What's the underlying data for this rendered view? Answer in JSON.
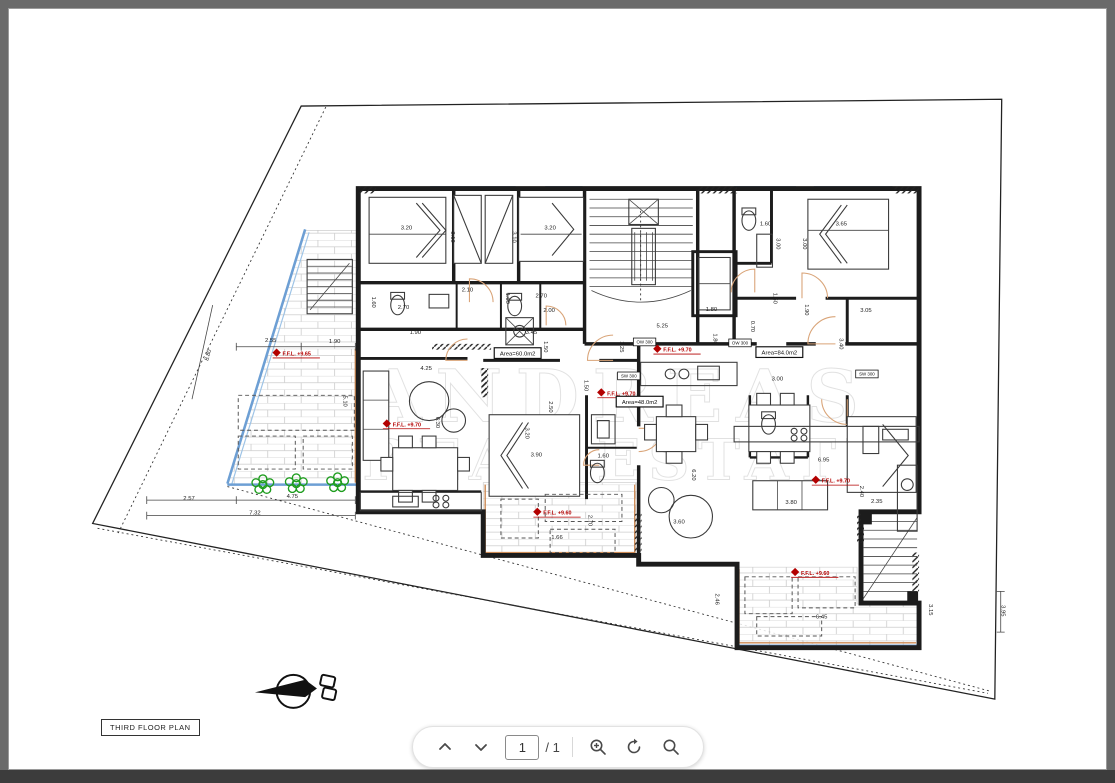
{
  "viewer": {
    "background_color": "#6a6a6a",
    "bottom_bar_color": "#3c3c3c",
    "title_box_label": "THIRD FLOOR PLAN",
    "toolbar": {
      "page_value": "1",
      "page_total": "/ 1",
      "icons": [
        "chevron-up",
        "chevron-down",
        "zoom-in",
        "rotate",
        "search"
      ]
    }
  },
  "watermark": {
    "line1": "ANDREAS",
    "line2": "REAL ESTATE"
  },
  "plan": {
    "colors": {
      "balcony_edge": "#6d9fd4",
      "door_arc": "#d9a478",
      "railing": "#cc8a54",
      "ffl_label": "#b30000",
      "plant": "#1f9d1f"
    },
    "area_labels": [
      {
        "text": "Area=60.0m2",
        "x": 517,
        "y": 357
      },
      {
        "text": "Area=48.0m2",
        "x": 641,
        "y": 407
      },
      {
        "text": "Area=84.0m2",
        "x": 783,
        "y": 356
      }
    ],
    "ffl_labels": [
      {
        "text": "F.F.L. +9.65",
        "x": 278,
        "y": 357
      },
      {
        "text": "F.F.L. +9.70",
        "x": 390,
        "y": 430
      },
      {
        "text": "F.F.L. +9.70",
        "x": 665,
        "y": 353
      },
      {
        "text": "F.F.L. +9.70",
        "x": 608,
        "y": 398
      },
      {
        "text": "F.F.L. +9.70",
        "x": 826,
        "y": 488
      },
      {
        "text": "F.F.L. +9.60",
        "x": 543,
        "y": 521
      },
      {
        "text": "F.F.L. +9.60",
        "x": 805,
        "y": 583
      }
    ],
    "window_tags": [
      {
        "text": "OW 300",
        "x": 646,
        "y": 345
      },
      {
        "text": "OW 300",
        "x": 743,
        "y": 346
      },
      {
        "text": "SW 300",
        "x": 630,
        "y": 380
      },
      {
        "text": "SW 300",
        "x": 872,
        "y": 378
      }
    ],
    "dimensions": [
      {
        "t": "3.20",
        "x": 404,
        "y": 227
      },
      {
        "t": "3.10",
        "x": 449,
        "y": 235,
        "r": 90
      },
      {
        "t": "3.20",
        "x": 550,
        "y": 227
      },
      {
        "t": "3.10",
        "x": 512,
        "y": 235,
        "r": 90
      },
      {
        "t": "2.10",
        "x": 466,
        "y": 291
      },
      {
        "t": "2.70",
        "x": 541,
        "y": 297
      },
      {
        "t": "2.00",
        "x": 549,
        "y": 312
      },
      {
        "t": "2.70",
        "x": 401,
        "y": 309
      },
      {
        "t": "1.60",
        "x": 369,
        "y": 302,
        "r": 90
      },
      {
        "t": "1.60",
        "x": 505,
        "y": 298,
        "r": 90
      },
      {
        "t": "1.90",
        "x": 413,
        "y": 335
      },
      {
        "t": "3.45",
        "x": 531,
        "y": 335
      },
      {
        "t": "1.50",
        "x": 544,
        "y": 348,
        "r": 90
      },
      {
        "t": "5.25",
        "x": 664,
        "y": 328
      },
      {
        "t": "1.25",
        "x": 621,
        "y": 348,
        "r": 90
      },
      {
        "t": "1.80",
        "x": 714,
        "y": 311
      },
      {
        "t": "1.80",
        "x": 716,
        "y": 340,
        "r": 90
      },
      {
        "t": "2.55",
        "x": 266,
        "y": 343
      },
      {
        "t": "1.90",
        "x": 331,
        "y": 344
      },
      {
        "t": "8.80",
        "x": 204,
        "y": 357,
        "r": -75
      },
      {
        "t": "5.10",
        "x": 340,
        "y": 404,
        "r": 90
      },
      {
        "t": "2.57",
        "x": 183,
        "y": 506
      },
      {
        "t": "4.75",
        "x": 288,
        "y": 504
      },
      {
        "t": "7.32",
        "x": 250,
        "y": 521
      },
      {
        "t": "4.25",
        "x": 424,
        "y": 372
      },
      {
        "t": "6.30",
        "x": 434,
        "y": 426,
        "r": 90
      },
      {
        "t": "3.20",
        "x": 525,
        "y": 437,
        "r": 90
      },
      {
        "t": "3.90",
        "x": 536,
        "y": 461
      },
      {
        "t": "1.60",
        "x": 604,
        "y": 462
      },
      {
        "t": "2.70",
        "x": 589,
        "y": 527,
        "r": 90
      },
      {
        "t": "2.50",
        "x": 549,
        "y": 410,
        "r": 90
      },
      {
        "t": "1.50",
        "x": 585,
        "y": 388,
        "r": 90
      },
      {
        "t": "3.60",
        "x": 681,
        "y": 530
      },
      {
        "t": "6.20",
        "x": 694,
        "y": 480,
        "r": 90
      },
      {
        "t": "1.66",
        "x": 557,
        "y": 546
      },
      {
        "t": "1.60",
        "x": 769,
        "y": 223
      },
      {
        "t": "3.65",
        "x": 846,
        "y": 223
      },
      {
        "t": "3.00",
        "x": 780,
        "y": 242,
        "r": 90
      },
      {
        "t": "3.00",
        "x": 807,
        "y": 242,
        "r": 90
      },
      {
        "t": "3.05",
        "x": 871,
        "y": 312
      },
      {
        "t": "3.40",
        "x": 844,
        "y": 345,
        "r": 90
      },
      {
        "t": "1.50",
        "x": 777,
        "y": 298,
        "r": 90
      },
      {
        "t": "1.90",
        "x": 809,
        "y": 310,
        "r": 90
      },
      {
        "t": "0.70",
        "x": 754,
        "y": 327,
        "r": 90
      },
      {
        "t": "3.00",
        "x": 781,
        "y": 383
      },
      {
        "t": "2.40",
        "x": 865,
        "y": 497,
        "r": 90
      },
      {
        "t": "2.35",
        "x": 882,
        "y": 509
      },
      {
        "t": "3.80",
        "x": 795,
        "y": 510
      },
      {
        "t": "6.95",
        "x": 828,
        "y": 466
      },
      {
        "t": "6.45",
        "x": 826,
        "y": 628
      },
      {
        "t": "2.46",
        "x": 718,
        "y": 608,
        "r": 90
      },
      {
        "t": "3.15",
        "x": 935,
        "y": 619,
        "r": 90
      },
      {
        "t": "3.95",
        "x": 1009,
        "y": 620,
        "r": 90
      }
    ]
  }
}
